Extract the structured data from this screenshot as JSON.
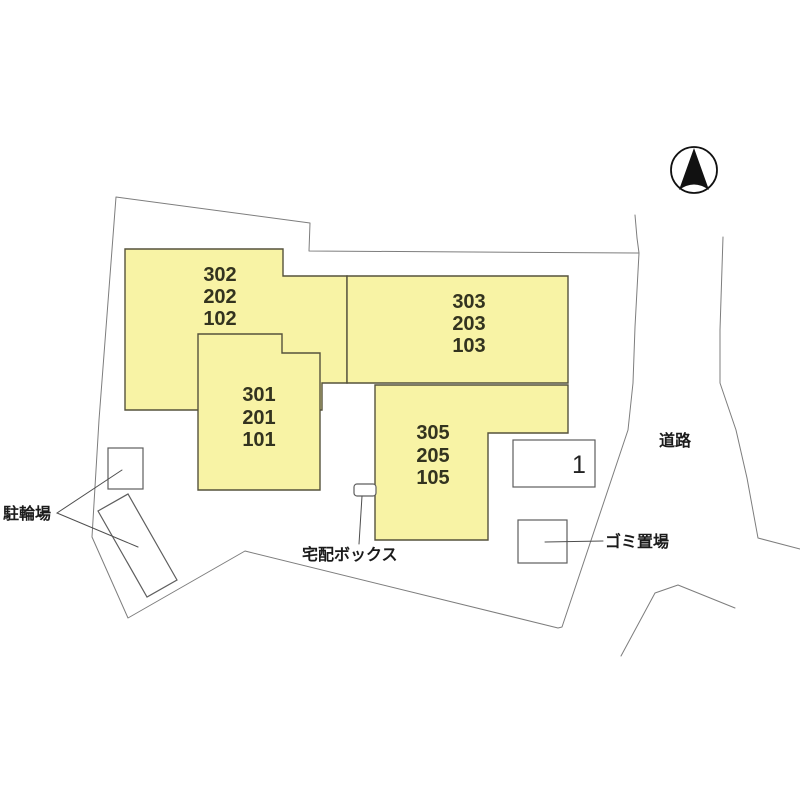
{
  "site_plan": {
    "buildings": [
      {
        "name": "building-west",
        "units": [
          "302",
          "202",
          "102"
        ]
      },
      {
        "name": "building-northeast",
        "units": [
          "303",
          "203",
          "103"
        ]
      },
      {
        "name": "building-center",
        "units": [
          "301",
          "201",
          "101"
        ]
      },
      {
        "name": "building-southeast",
        "units": [
          "305",
          "205",
          "105"
        ]
      }
    ],
    "parking_space_label": "1",
    "labels": {
      "bicycle_parking": "駐輪場",
      "delivery_box": "宅配ボックス",
      "garbage_area": "ゴミ置場",
      "road": "道路"
    },
    "compass_icon": "north-arrow",
    "colors": {
      "building_fill": "#f8f3a5",
      "building_stroke": "#55523c",
      "boundary_stroke": "#7d7d7d",
      "unit_text": "#33331f",
      "label_text": "#1b1b1b"
    }
  }
}
